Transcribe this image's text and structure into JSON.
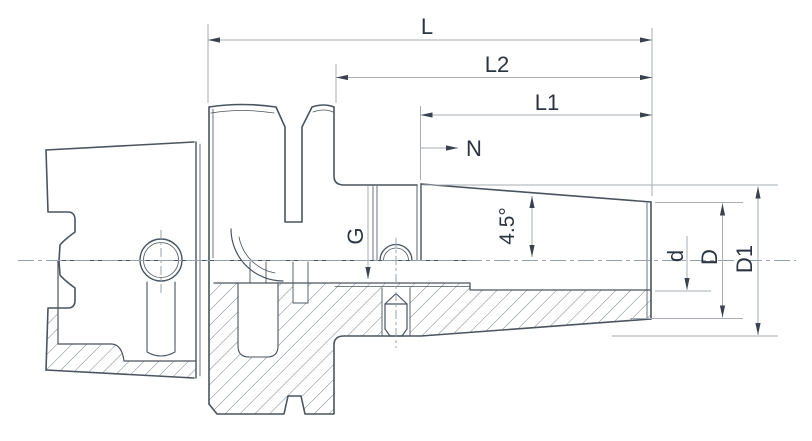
{
  "drawing": {
    "title": "shrink-fit tool holder half-section drawing",
    "labels": {
      "L": "L",
      "L2": "L2",
      "L1": "L1",
      "N": "N",
      "G": "G",
      "angle": "4.5°",
      "d": "d",
      "D": "D",
      "D1": "D1"
    },
    "colors": {
      "outline": "#4a545e",
      "dimension_line": "#a7adb3",
      "arrow": "#39424d",
      "text": "#2b3440",
      "hatch": "#6b7682",
      "background": "#ffffff"
    }
  }
}
